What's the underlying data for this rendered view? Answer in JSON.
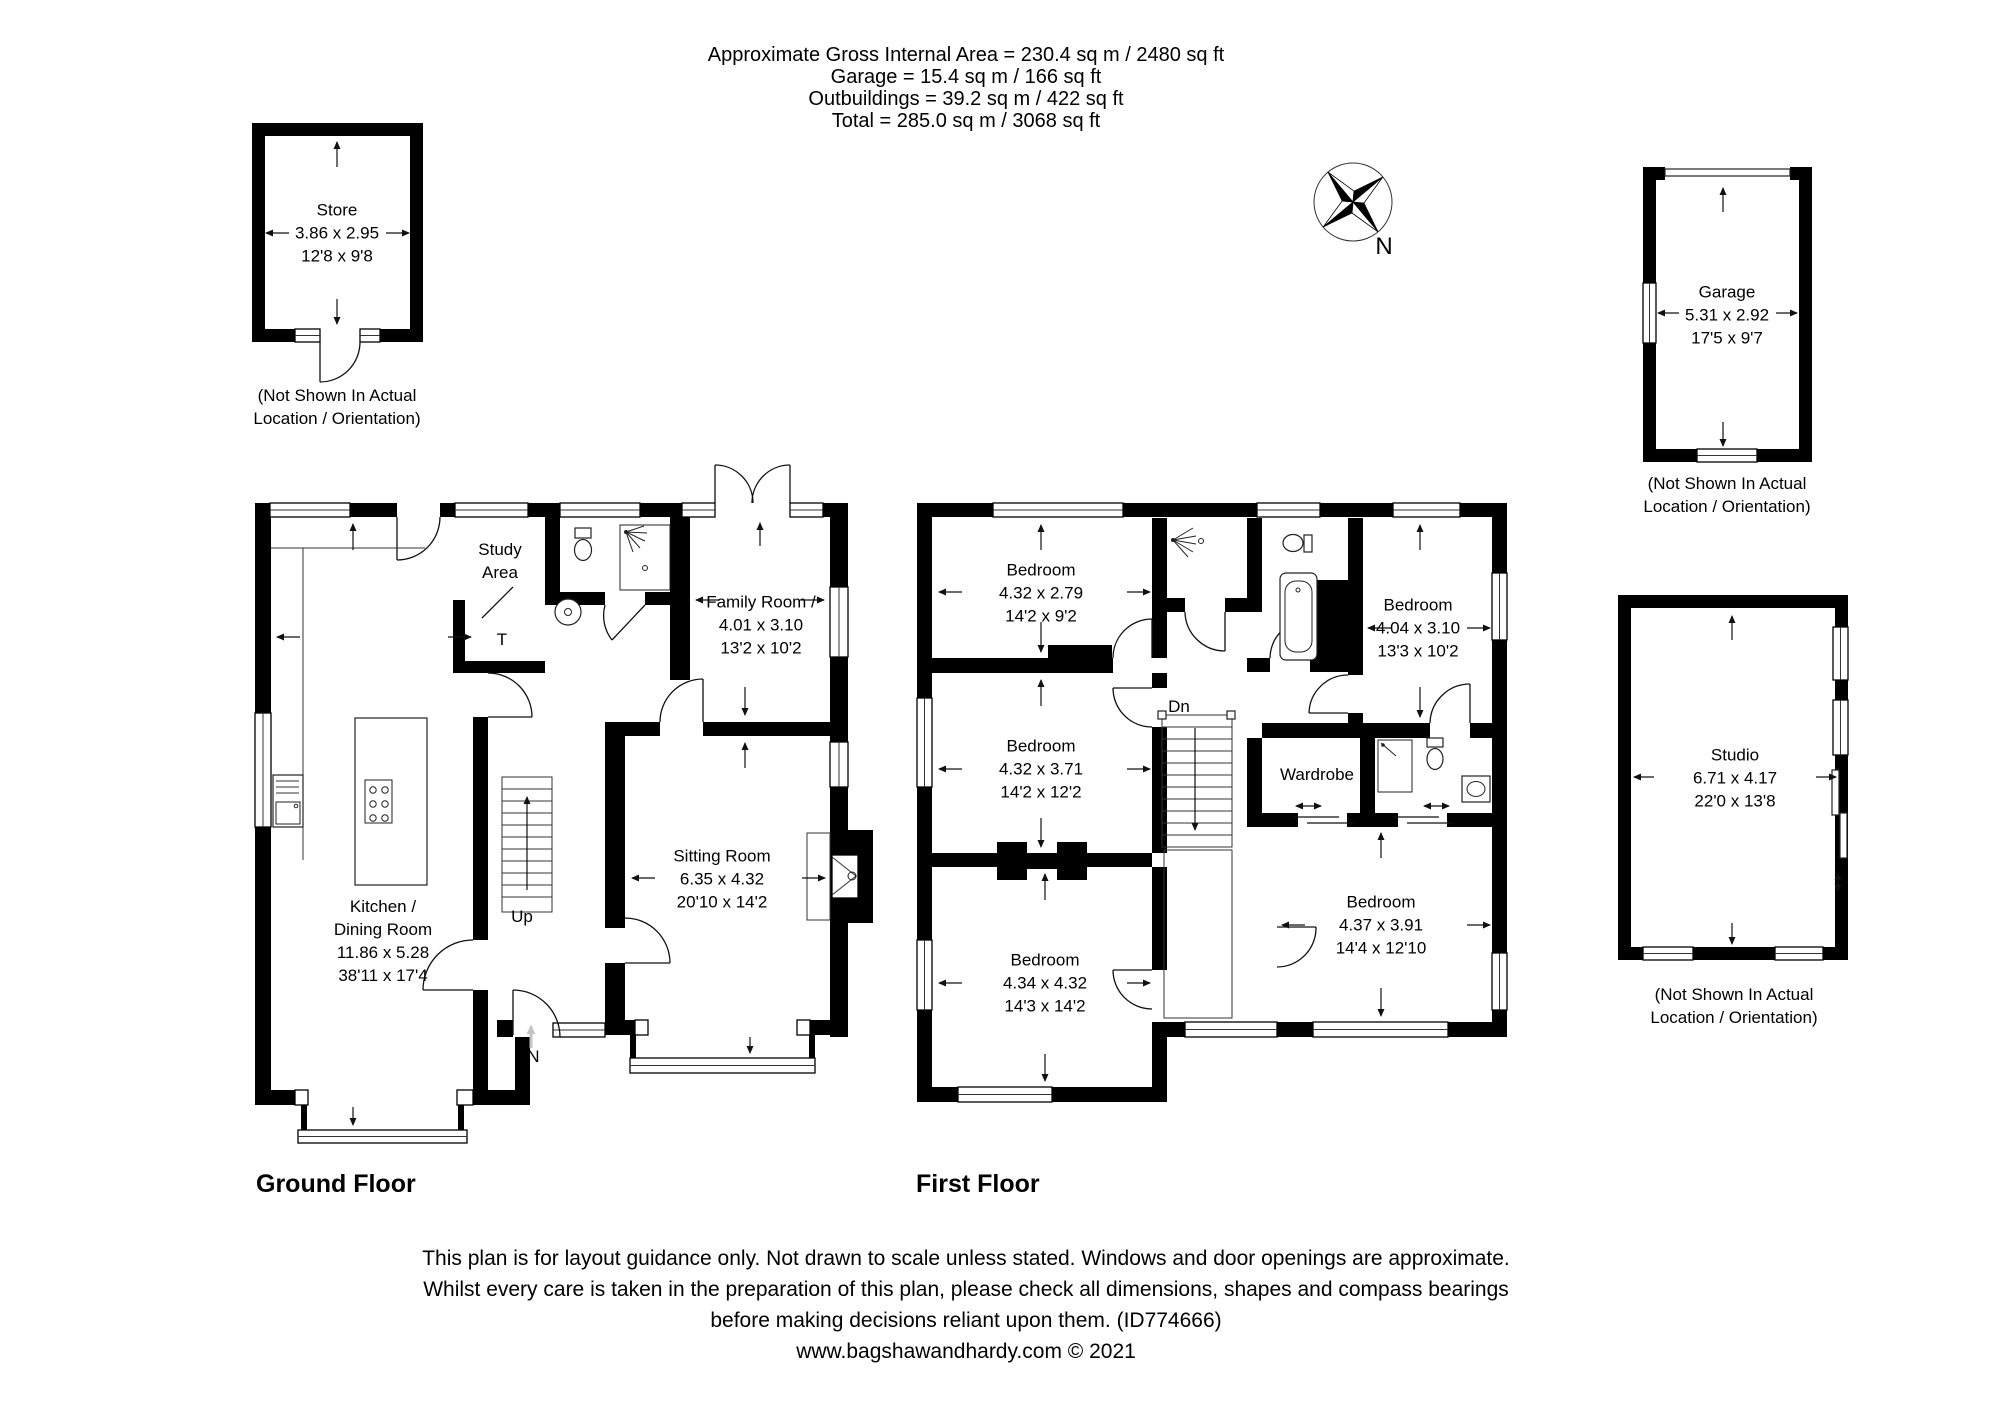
{
  "header": {
    "lines": [
      "Approximate Gross Internal Area = 230.4 sq m / 2480 sq ft",
      "Garage = 15.4 sq m / 166 sq ft",
      "Outbuildings = 39.2 sq m / 422 sq ft",
      "Total = 285.0 sq m / 3068 sq ft"
    ]
  },
  "compass": {
    "north_label": "N"
  },
  "outbuildings": {
    "store": {
      "name": "Store",
      "metric": "3.86 x 2.95",
      "imperial": "12'8 x 9'8",
      "caption_lines": [
        "(Not Shown In Actual",
        "Location / Orientation)"
      ]
    },
    "garage": {
      "name": "Garage",
      "metric": "5.31 x 2.92",
      "imperial": "17'5 x 9'7",
      "caption_lines": [
        "(Not Shown In Actual",
        "Location / Orientation)"
      ]
    },
    "studio": {
      "name": "Studio",
      "metric": "6.71 x 4.17",
      "imperial": "22'0 x 13'8",
      "caption_lines": [
        "(Not Shown In Actual",
        "Location / Orientation)"
      ]
    }
  },
  "floors": {
    "ground": {
      "title": "Ground Floor",
      "rooms": {
        "study_area": {
          "name_lines": [
            "Study",
            "Area"
          ]
        },
        "family_room": {
          "name": "Family Room /",
          "metric": "4.01 x 3.10",
          "imperial": "13'2 x 10'2"
        },
        "sitting_room": {
          "name": "Sitting Room",
          "metric": "6.35 x 4.32",
          "imperial": "20'10 x 14'2"
        },
        "kitchen_dining": {
          "name_lines": [
            "Kitchen /",
            "Dining Room"
          ],
          "metric": "11.86 x 5.28",
          "imperial": "38'11 x 17'4"
        }
      },
      "annotations": {
        "up": "Up",
        "entrance": "IN",
        "toilet": "T"
      }
    },
    "first": {
      "title": "First Floor",
      "rooms": {
        "bedroom_1": {
          "name": "Bedroom",
          "metric": "4.32 x 2.79",
          "imperial": "14'2 x 9'2"
        },
        "bedroom_2": {
          "name": "Bedroom",
          "metric": "4.04 x 3.10",
          "imperial": "13'3 x 10'2"
        },
        "bedroom_3": {
          "name": "Bedroom",
          "metric": "4.32 x 3.71",
          "imperial": "14'2 x 12'2"
        },
        "bedroom_4": {
          "name": "Bedroom",
          "metric": "4.34 x 4.32",
          "imperial": "14'3 x 14'2"
        },
        "bedroom_5": {
          "name": "Bedroom",
          "metric": "4.37 x 3.91",
          "imperial": "14'4 x 12'10"
        },
        "wardrobe": {
          "name": "Wardrobe"
        }
      },
      "annotations": {
        "down": "Dn"
      }
    }
  },
  "footer": {
    "lines": [
      "This plan is for layout guidance only. Not drawn to scale unless stated. Windows and door openings are approximate.",
      "Whilst every care is taken in the preparation of this plan, please check all dimensions, shapes and compass bearings",
      "before making decisions reliant upon them. (ID774666)"
    ],
    "credit": "www.bagshawandhardy.com © 2021"
  },
  "colors": {
    "wall": "#000000",
    "line": "#1a1a1a",
    "muted_arrow": "#c4c4c4"
  }
}
